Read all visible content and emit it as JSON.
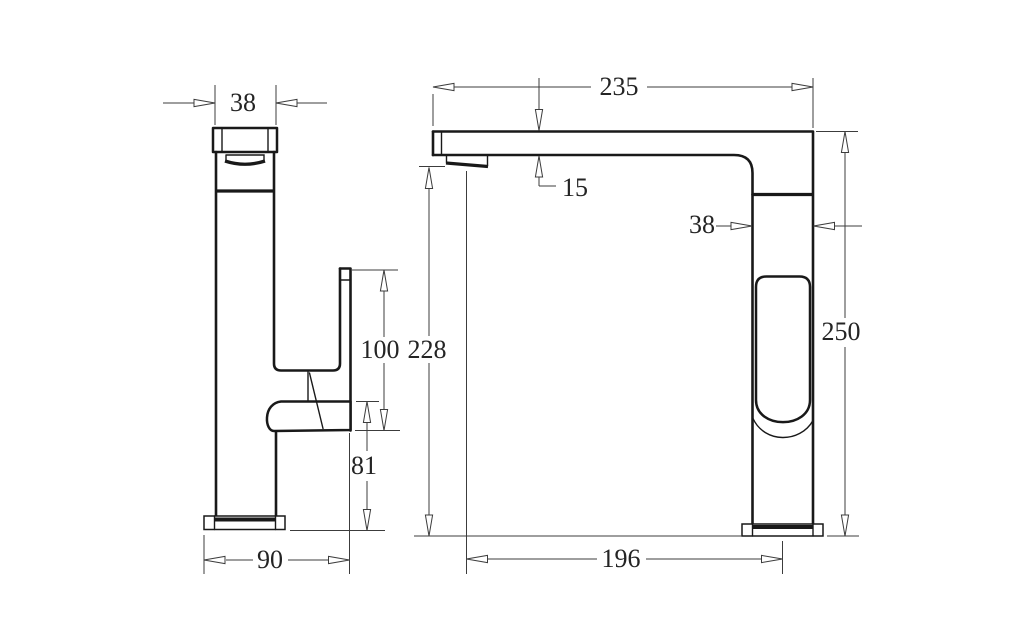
{
  "page": {
    "background": "#ffffff"
  },
  "drawing": {
    "type": "technical-dimension-drawing",
    "subject": "sink mixer tap, two orthographic views",
    "object_line_color": "#191919",
    "dimension_line_color": "#3c3c3c",
    "dims": {
      "side_spout_width": "38",
      "side_handle_length": "100",
      "side_pivot_height": "81",
      "side_base_depth": "90",
      "front_spout_reach": "235",
      "front_spout_thickness": "15",
      "front_body_width": "38",
      "front_overall_height": "250",
      "front_underspout_height": "228",
      "front_reach_to_center": "196"
    }
  }
}
